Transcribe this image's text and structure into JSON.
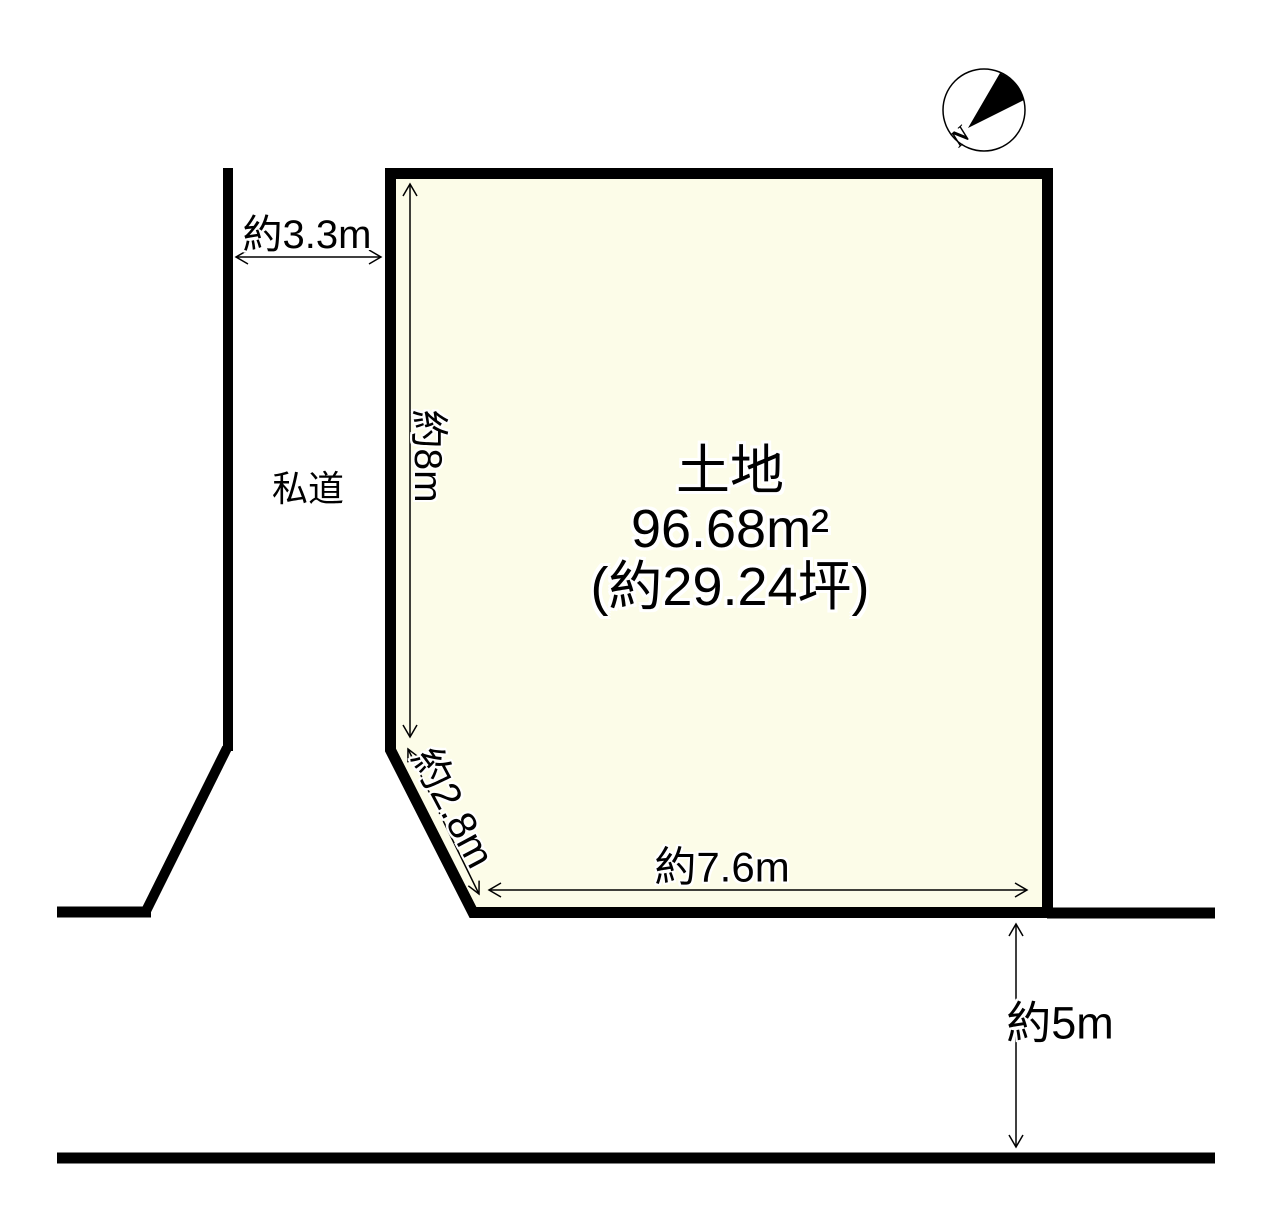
{
  "compass": {
    "label": "N"
  },
  "plot": {
    "name": "土地",
    "area_m2": "96.68m²",
    "area_tsubo": "(約29.24坪)"
  },
  "roads": {
    "private_road_label": "私道"
  },
  "dimensions": {
    "private_road_width": "約3.3m",
    "west_side": "約8m",
    "diagonal_side": "約2.8m",
    "south_side": "約7.6m",
    "south_road_width": "約5m"
  },
  "colors": {
    "plot_fill": "#FCFCE8",
    "line": "#000000",
    "background": "#FFFFFF"
  }
}
